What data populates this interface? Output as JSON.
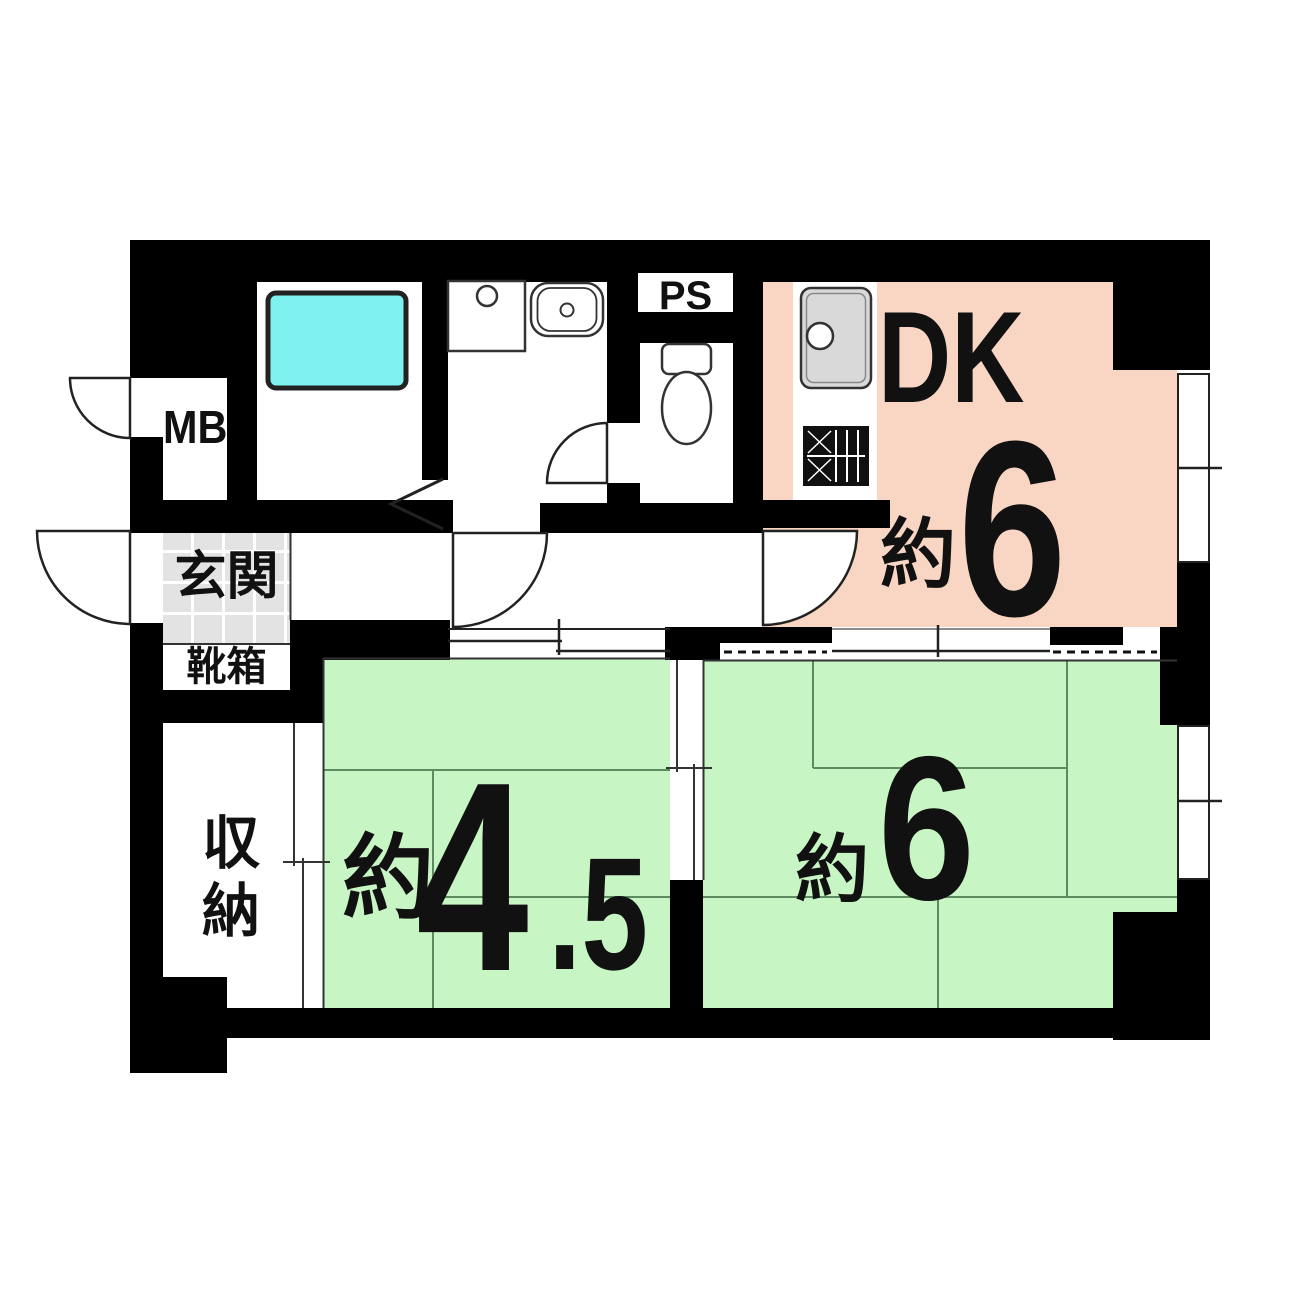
{
  "plan": {
    "type": "japanese-apartment-floor-plan",
    "labels": {
      "meter_box": "MB",
      "pipe_space": "PS",
      "entrance": "玄関",
      "shoe_box": "靴箱",
      "storage": "収納"
    },
    "rooms": {
      "dk": {
        "name": "DK",
        "approx": "約",
        "size": "6"
      },
      "tatami_west": {
        "approx": "約",
        "size_int": "4",
        "size_frac": ".5"
      },
      "tatami_east": {
        "approx": "約",
        "size": "6"
      }
    },
    "fixtures": [
      "bathtub",
      "washing-machine-pan",
      "washbasin",
      "toilet",
      "kitchen-sink",
      "gas-stove"
    ],
    "colors": {
      "wall": "#000000",
      "dk_floor": "#f9d5c3",
      "tatami_floor": "#c8f5c4",
      "tatami_line": "#5d8b60",
      "bathtub": "#7ef2f0",
      "entrance_tile": "#e3e3e3",
      "sink_gray": "#d9d9d9"
    }
  }
}
